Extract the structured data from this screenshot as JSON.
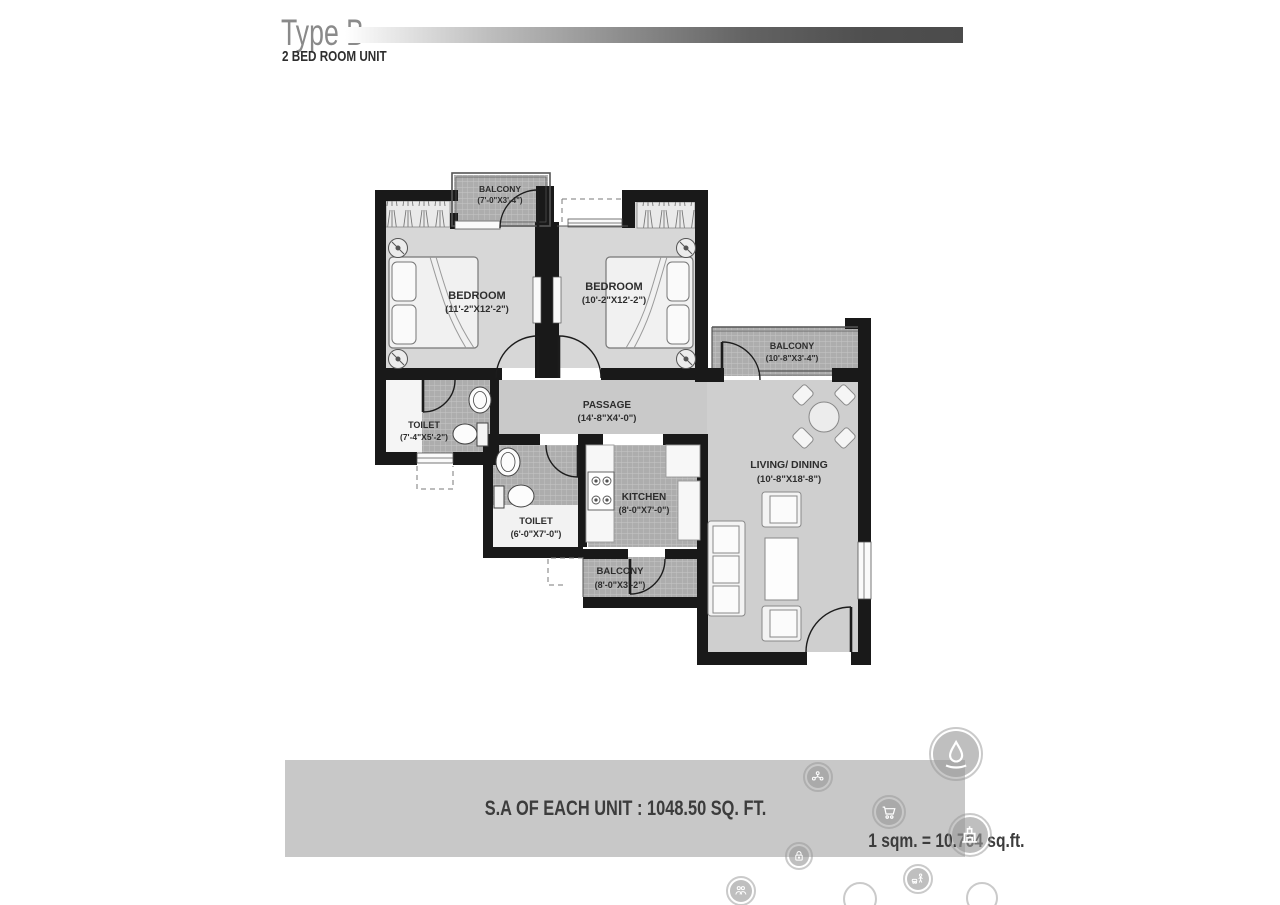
{
  "header": {
    "title": "Type B",
    "subtitle": "2 BED ROOM UNIT"
  },
  "rooms": {
    "balcony_top": {
      "name": "BALCONY",
      "dims": "(7'-0\"X3'-4\")"
    },
    "bedroom_left": {
      "name": "BEDROOM",
      "dims": "(11'-2\"X12'-2\")"
    },
    "bedroom_right": {
      "name": "BEDROOM",
      "dims": "(10'-2\"X12'-2\")"
    },
    "balcony_right": {
      "name": "BALCONY",
      "dims": "(10'-8\"X3'-4\")"
    },
    "passage": {
      "name": "PASSAGE",
      "dims": "(14'-8\"X4'-0\")"
    },
    "toilet_left": {
      "name": "TOILET",
      "dims": "(7'-4\"X5'-2\")"
    },
    "toilet_center": {
      "name": "TOILET",
      "dims": "(6'-0\"X7'-0\")"
    },
    "kitchen": {
      "name": "KITCHEN",
      "dims": "(8'-0\"X7'-0\")"
    },
    "balcony_bottom": {
      "name": "BALCONY",
      "dims": "(8'-0\"X3'-2\")"
    },
    "living_dining": {
      "name": "LIVING/ DINING",
      "dims": "(10'-8\"X18'-8\")"
    }
  },
  "footer": {
    "area_text": "S.A OF EACH UNIT : 1048.50 SQ. FT.",
    "conversion": "1 sqm. = 10.764 sq.ft."
  },
  "colors": {
    "wall": "#191919",
    "tile_base": "#adadad",
    "tile_line": "#c6c6c6",
    "floor": "#d7d7d7",
    "passage_floor": "#c9c9c9",
    "living_floor": "#cfcfcf",
    "banner": "#c8c8c8",
    "gradient_end": "#4b4b4b"
  },
  "icons": {
    "watermarks": [
      "community-icon",
      "water-drop-icon",
      "shopping-cart-icon",
      "monument-icon",
      "padlock-icon",
      "play-area-icon",
      "people-icon",
      "ring-icon",
      "ring-icon"
    ]
  }
}
